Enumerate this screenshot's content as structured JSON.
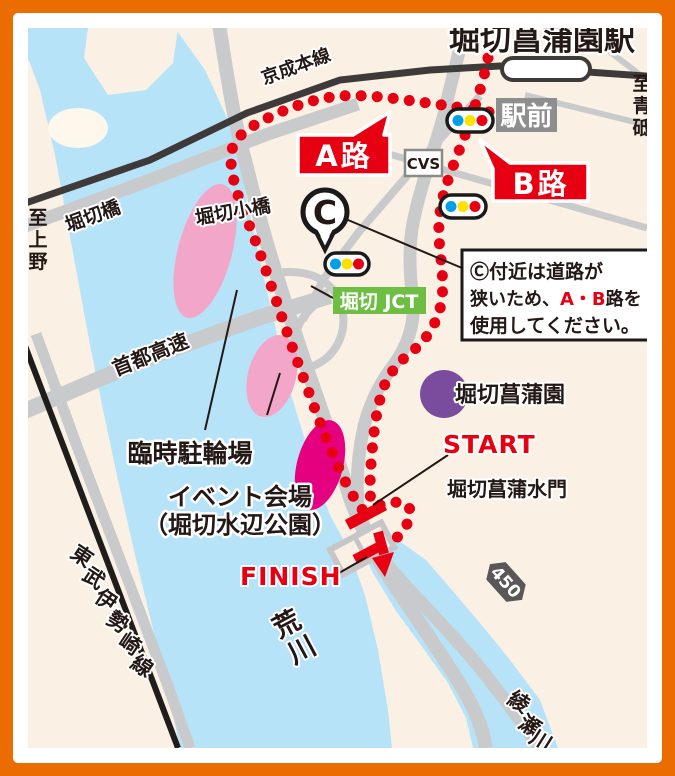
{
  "station": {
    "name": "堀切菖蒲園駅"
  },
  "railways": {
    "keisei": "京成本線",
    "tobu": [
      "東",
      "武",
      "伊",
      "勢",
      "崎",
      "線"
    ]
  },
  "directions": {
    "to_aoto": [
      "至",
      "青",
      "砥"
    ],
    "to_ueno": [
      "至",
      "上",
      "野"
    ]
  },
  "bridges": {
    "horikiri": "堀切橋",
    "horikiri_small": "堀切小橋"
  },
  "route_labels": {
    "a": "A路",
    "b": "B路"
  },
  "markers": {
    "c": "C",
    "start": "START",
    "finish": "FINISH"
  },
  "note": {
    "line1": "Ⓒ付近は道路が",
    "line2_pre": "狭いため、",
    "line2_red": "A・B",
    "line2_post": "路を",
    "line3": "使用してください。"
  },
  "pois": {
    "cvs": "CVS",
    "ekimae": "駅前",
    "jct": "堀切 JCT",
    "shuto_expressway": "首都高速",
    "bicycle_parking": "臨時駐輪場",
    "venue_line1": "イベント会場",
    "venue_line2": "（堀切水辺公園）",
    "garden": "堀切菖蒲園",
    "floodgate": "堀切菖蒲水門",
    "route_450": "450"
  },
  "rivers": {
    "arakawa": [
      "荒",
      "川"
    ],
    "ayase": [
      "綾",
      "瀬",
      "川"
    ]
  },
  "colors": {
    "frame_orange": "#EB6C00",
    "land_cream": "#FAF1E4",
    "water_blue": "#B7E3F9",
    "road_gray": "#C9CACB",
    "rail_dark": "#3E3A39",
    "route_red": "#E60012",
    "jct_green": "#6FBE44",
    "garden_purple": "#7A4C9E",
    "parking_pink": "#F2A7C9",
    "venue_magenta": "#E4007F",
    "label_gray_bg": "#8E8E8F",
    "signal_blue": "#00A0E9",
    "signal_yellow": "#FFE100",
    "shield_gray": "#595757"
  }
}
